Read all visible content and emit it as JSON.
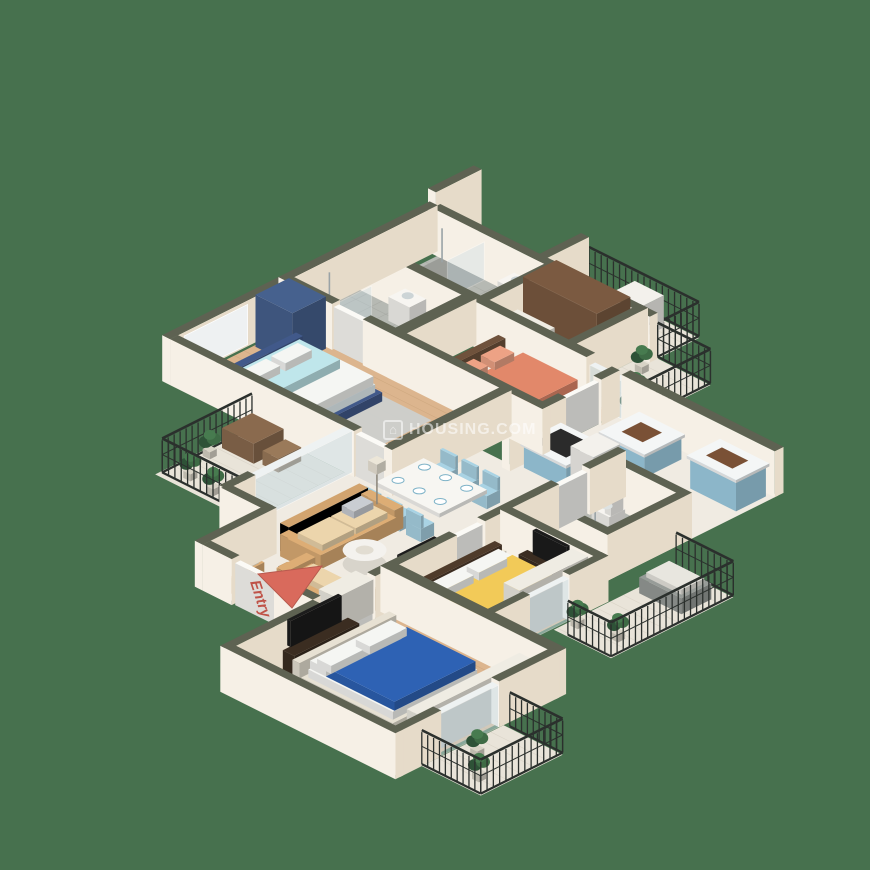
{
  "canvas": {
    "width": 870,
    "height": 870
  },
  "labels": {
    "entry": "Entry"
  },
  "watermark": {
    "text": "HOUSING.COM",
    "icon": "housing-logo",
    "color": "rgba(255,255,255,0.55)"
  },
  "colors": {
    "background": "#47714e",
    "wallTop": "#5e6252",
    "wallFaceLight": "#f6f0e6",
    "wallFaceDark": "#e6dbc9",
    "floorWood": "#dcb58e",
    "plankLine": "#c09b72",
    "floorMarble": "#f0ebe2",
    "floorTile": "#b6b9b3",
    "tileLine": "#9da09a",
    "balconyFloor": "#e9e4d9",
    "balconyLine": "#d2ccbe",
    "railing": "#2b302d",
    "glassFill": "#c9dde6",
    "white": "#f7f5f1",
    "bedCoral": "#e2886a",
    "pillowCoral": "#eda285",
    "bedCyan": "#bfe6eb",
    "duvetWhite": "#f5f6f3",
    "bedYellow": "#f2ca58",
    "bedBlue": "#2e62b4",
    "frameBlue": "#41598a",
    "frameWood": "#6f523c",
    "frameLight": "#e7e1d3",
    "sofaTan": "#ddad75",
    "sofaCushion": "#ecd5ac",
    "chairBlue": "#a9d3e4",
    "kitchenBlue": "#9fcfe4",
    "wardrobeBrown": "#7b5a41",
    "wardrobeNavy": "#46618e",
    "wardrobeWhite": "#efece3",
    "rugGray": "#ccd0cd",
    "tvDark": "#3b2d21",
    "black": "#1c1c1c",
    "applianceWhite": "#f3f1ec",
    "plantGreen": "#3e6b45",
    "plantDark": "#2e5237",
    "potGray": "#d8d3c6",
    "benchGray": "#979c98",
    "arrowRed": "#d96a5c",
    "entryText": "#bf5348",
    "copperSink": "#7a5136"
  },
  "scene": {
    "type": "isometric-3d-floor-plan",
    "rooms": [
      {
        "name": "utility-balcony",
        "items": [
          "washing-machine",
          "railing"
        ]
      },
      {
        "name": "bathroom-top-right",
        "items": [
          "shower",
          "washbasin",
          "toilet"
        ]
      },
      {
        "name": "walk-in-wardrobe",
        "items": [
          "brown-wardrobe",
          "dresser"
        ]
      },
      {
        "name": "kitchen-balcony",
        "items": [
          "plants",
          "railing"
        ]
      },
      {
        "name": "bathroom-top-left",
        "items": [
          "shower",
          "washbasin",
          "toilet"
        ]
      },
      {
        "name": "master-bedroom",
        "items": [
          "double-bed-coral",
          "nightstand",
          "tv-console"
        ]
      },
      {
        "name": "bedroom-cyan",
        "items": [
          "double-bed-cyan",
          "navy-wardrobe",
          "sliding-closet"
        ]
      },
      {
        "name": "kitchen",
        "items": [
          "sink-counter",
          "hob-island",
          "tall-cabinet",
          "refrigerator"
        ]
      },
      {
        "name": "bathroom-middle",
        "items": [
          "toilet",
          "washbasin",
          "shower"
        ]
      },
      {
        "name": "living-dining",
        "items": [
          "dining-table-six-chairs",
          "sofa-set",
          "coffee-table",
          "tv-console",
          "floor-lamp"
        ]
      },
      {
        "name": "west-balcony",
        "items": [
          "coffee-table-set",
          "plants",
          "railing"
        ]
      },
      {
        "name": "foyer",
        "items": [
          "shoe-cabinet",
          "bench",
          "entry-door",
          "entry-arrow"
        ]
      },
      {
        "name": "bedroom-yellow",
        "items": [
          "double-bed-yellow",
          "wardrobe",
          "tv-unit",
          "nightstands"
        ]
      },
      {
        "name": "east-balcony",
        "items": [
          "bench",
          "plants",
          "railing"
        ]
      },
      {
        "name": "bedroom-blue",
        "items": [
          "double-bed-blue",
          "sliding-wardrobe",
          "tv-console",
          "foot-bench"
        ]
      },
      {
        "name": "south-balcony",
        "items": [
          "plants",
          "railing"
        ]
      }
    ]
  }
}
